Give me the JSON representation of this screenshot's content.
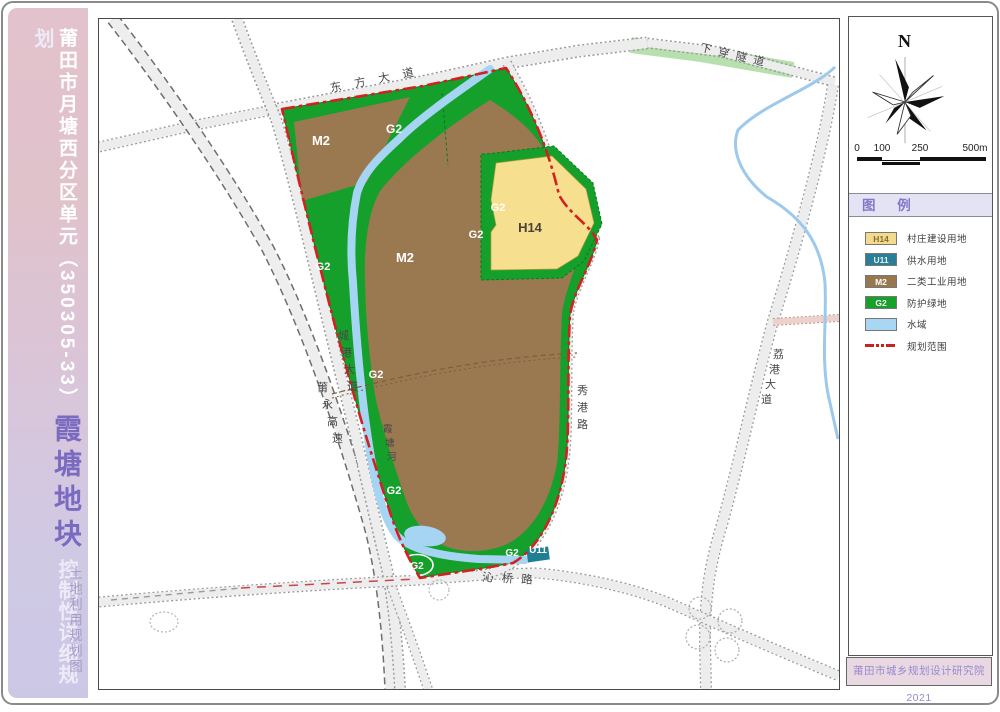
{
  "left_panel": {
    "title_main": "莆田市月塘西分区单元（350305-33）",
    "title_block": "霞塘地块",
    "title_sub": "控制性详细规划",
    "side_note": "土地利用规划图"
  },
  "map": {
    "area_labels": [
      {
        "t": "M2",
        "x": 320,
        "y": 144,
        "s": 13
      },
      {
        "t": "G2",
        "x": 393,
        "y": 132,
        "s": 12
      },
      {
        "t": "M2",
        "x": 404,
        "y": 261,
        "s": 13
      },
      {
        "t": "G2",
        "x": 497,
        "y": 210,
        "s": 11
      },
      {
        "t": "G2",
        "x": 475,
        "y": 237,
        "s": 11
      },
      {
        "t": "H14",
        "x": 529,
        "y": 231,
        "s": 13,
        "c": "#4a4238"
      },
      {
        "t": "G2",
        "x": 322,
        "y": 269,
        "s": 11
      },
      {
        "t": "G2",
        "x": 375,
        "y": 377,
        "s": 11
      },
      {
        "t": "G2",
        "x": 393,
        "y": 493,
        "s": 11
      },
      {
        "t": "G2",
        "x": 416,
        "y": 568,
        "s": 10
      },
      {
        "t": "G2",
        "x": 511,
        "y": 555,
        "s": 10
      },
      {
        "t": "U11",
        "x": 537,
        "y": 552,
        "s": 10
      }
    ],
    "road_labels": [
      {
        "t": "东方大道",
        "x": 330,
        "y": 91,
        "r": -11,
        "sp": 13,
        "s": 11.5
      },
      {
        "t": "下穿隧道",
        "x": 699,
        "y": 50,
        "r": 13,
        "sp": 7,
        "s": 11
      },
      {
        "t": "沁桥路",
        "x": 481,
        "y": 580,
        "r": 3,
        "sp": 8,
        "s": 11.5
      },
      {
        "t": "莆永高速",
        "x": 316,
        "y": 390,
        "v": 1,
        "dy": 17,
        "dx": 5,
        "s": 11
      },
      {
        "t": "城港大道",
        "x": 337,
        "y": 338,
        "v": 1,
        "dy": 17,
        "dx": 3,
        "s": 11
      },
      {
        "t": "霞塘河",
        "x": 382,
        "y": 431,
        "v": 1,
        "dy": 14,
        "dx": 2,
        "s": 9.5
      },
      {
        "t": "秀港路",
        "x": 576,
        "y": 393,
        "v": 1,
        "dy": 17,
        "dx": 0,
        "s": 11
      },
      {
        "t": "荔港大道",
        "x": 772,
        "y": 357,
        "v": 1,
        "dy": 15,
        "dx": -4,
        "s": 11
      }
    ]
  },
  "right_panel": {
    "north": "N",
    "scale_ticks": [
      "0",
      "100",
      "250",
      "500m"
    ],
    "legend_title": "图 例",
    "legend": [
      {
        "code": "H14",
        "label": "村庄建设用地",
        "fill": "#f2dc8b",
        "tc": "#8a6d35"
      },
      {
        "code": "U11",
        "label": "供水用地",
        "fill": "#2b7e98",
        "tc": "#dff0f5"
      },
      {
        "code": "M2",
        "label": "二类工业用地",
        "fill": "#97774e",
        "tc": "#ffffff"
      },
      {
        "code": "G2",
        "label": "防护绿地",
        "fill": "#16a12b",
        "tc": "#ffffff"
      },
      {
        "code": "",
        "label": "水域",
        "fill": "#a9d6f3",
        "tc": ""
      },
      {
        "code": "__line__",
        "label": "规划范围",
        "fill": "#cc2121",
        "tc": ""
      }
    ],
    "attribution": "莆田市城乡规划设计研究院 2021"
  }
}
